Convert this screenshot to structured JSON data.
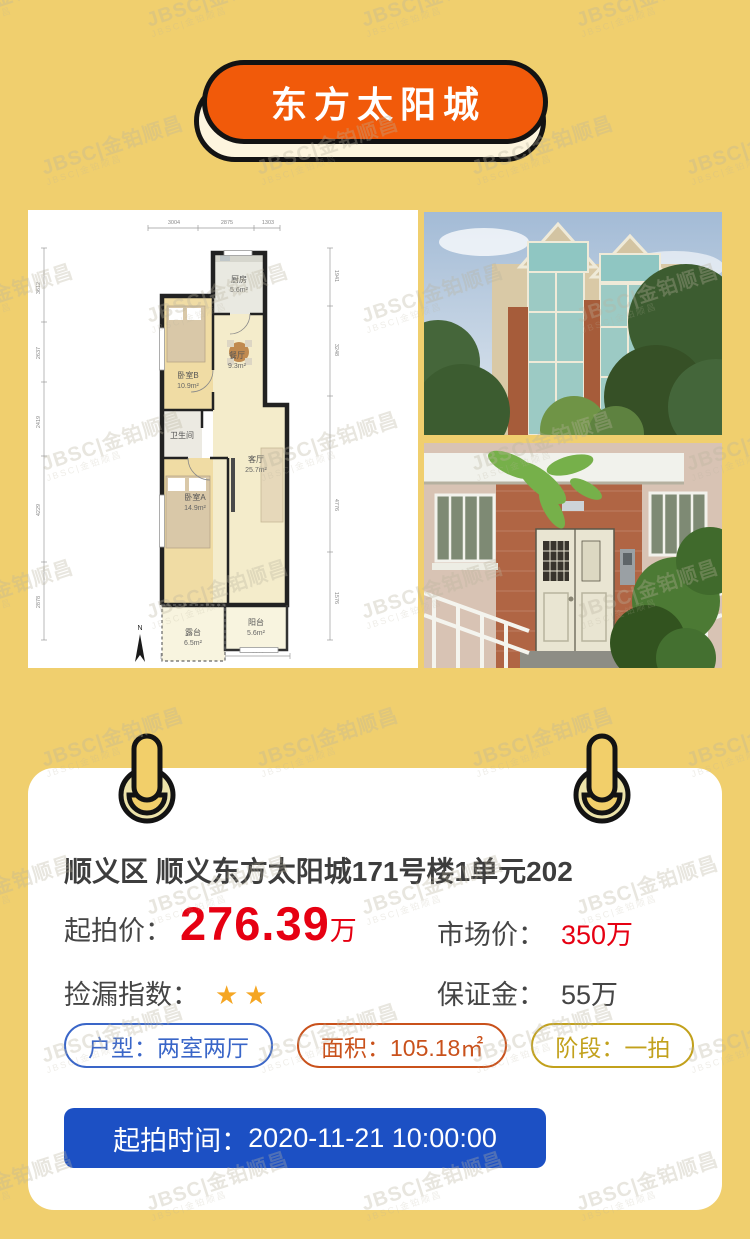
{
  "watermark": {
    "text": "JBSC|金铂顺昌"
  },
  "header": {
    "title": "东方太阳城"
  },
  "floorplan": {
    "rooms": [
      {
        "name": "厨房",
        "area": "5.6m²"
      },
      {
        "name": "餐厅",
        "area": "9.3m²"
      },
      {
        "name": "卧室B",
        "area": "10.9m²"
      },
      {
        "name": "卫生间",
        "area": ""
      },
      {
        "name": "客厅",
        "area": "25.7m²"
      },
      {
        "name": "卧室A",
        "area": "14.9m²"
      },
      {
        "name": "露台",
        "area": "6.5m²"
      },
      {
        "name": "阳台",
        "area": "5.6m²"
      }
    ],
    "dims": {
      "top": [
        "3004",
        "2875",
        "1303"
      ],
      "bottom": [
        "3518",
        "3670"
      ],
      "left": [
        "3612",
        "2637",
        "2419",
        "4229",
        "2878"
      ],
      "right": [
        "1941",
        "3248",
        "4776",
        "1576"
      ]
    },
    "north": "N"
  },
  "listing": {
    "title": "顺义区 顺义东方太阳城171号楼1单元202",
    "start_price": {
      "label": "起拍价：",
      "value": "276.39",
      "unit": "万"
    },
    "market_price": {
      "label": "市场价：",
      "value": "350万"
    },
    "bargain": {
      "label": "捡漏指数：",
      "stars": "★★"
    },
    "deposit": {
      "label": "保证金：",
      "value": "55万"
    },
    "tags": [
      {
        "text": "户型：两室两厅",
        "color": "#3A66C8"
      },
      {
        "text": "面积：105.18㎡",
        "color": "#C9511B"
      },
      {
        "text": "阶段：一拍",
        "color": "#C2A11C"
      }
    ],
    "auction_time": {
      "label": "起拍时间：",
      "value": "2020-11-21 10:00:00"
    }
  },
  "colors": {
    "background": "#F0CF6E",
    "banner_orange": "#F15A0A",
    "outline_black": "#131313",
    "price_red": "#E60012",
    "star_gold": "#F5A623",
    "button_blue": "#1C50C4",
    "card_white": "#FFFFFF"
  }
}
